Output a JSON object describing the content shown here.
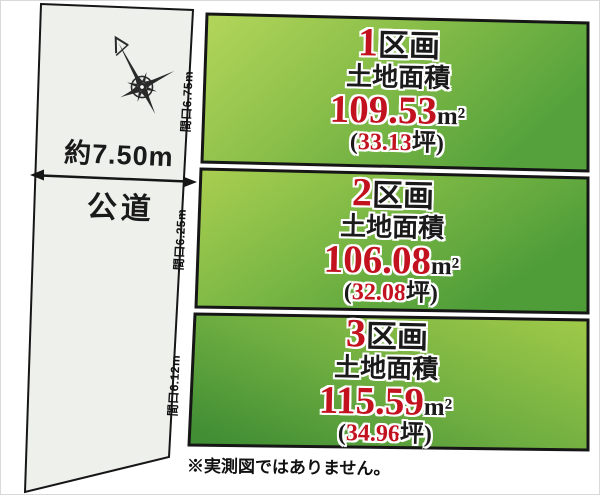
{
  "diagram_title": "land-subdivision-plan",
  "colors": {
    "accent_red": "#c3121f",
    "text_black": "#1a1a1a",
    "road_fill": "#eef0ec",
    "parcel_green_light": "#b2d457",
    "parcel_green_dark": "#4e9c38",
    "border_black": "#161616"
  },
  "road": {
    "width_label": "約7.50m",
    "name_label": "公道"
  },
  "compass": {
    "icon": "compass-rose"
  },
  "parcels": [
    {
      "number": "1",
      "block_suffix": "区画",
      "area_caption": "土地面積",
      "area_value": "109.53",
      "area_unit": "m²",
      "tsubo_open": "(",
      "tsubo_value": "33.13",
      "tsubo_close": "坪)",
      "frontage_label": "間口6.75m"
    },
    {
      "number": "2",
      "block_suffix": "区画",
      "area_caption": "土地面積",
      "area_value": "106.08",
      "area_unit": "m²",
      "tsubo_open": "(",
      "tsubo_value": "32.08",
      "tsubo_close": "坪)",
      "frontage_label": "間口6.25m"
    },
    {
      "number": "3",
      "block_suffix": "区画",
      "area_caption": "土地面積",
      "area_value": "115.59",
      "area_unit": "m²",
      "tsubo_open": "(",
      "tsubo_value": "34.96",
      "tsubo_close": "坪)",
      "frontage_label": "間口6.12m"
    }
  ],
  "footnote": "※実測図ではありません。"
}
